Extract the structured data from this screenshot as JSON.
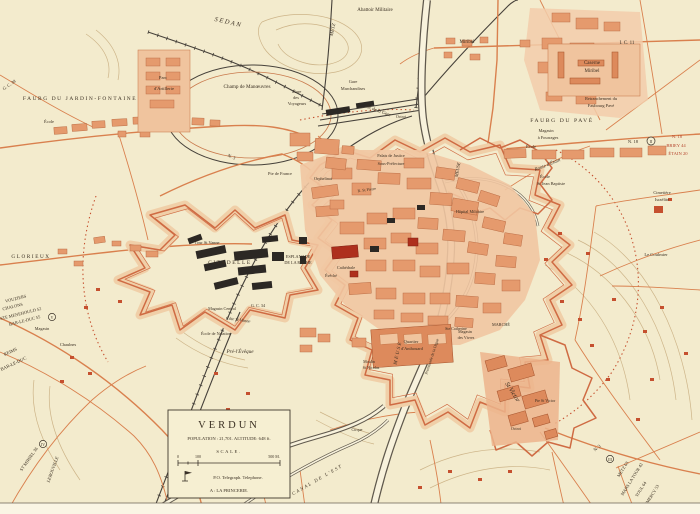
{
  "title": "Plan of Verdun",
  "colors": {
    "background": "#f3ebcd",
    "urban": "#e59a6d",
    "urban_dark": "#dd8a5c",
    "fort_line": "#cf6b43",
    "key_building": "#ae2f1d",
    "military_black": "#2c2824",
    "road": "#d9804e",
    "rail": "#46413a",
    "red_text": "#b5442c"
  },
  "legend": {
    "title": "VERDUN",
    "stats": "POPULATION : 21,701.   ALTITUDE: 648 ft.",
    "scale_label": "SCALE.",
    "tick0": "0",
    "tick100": "100",
    "tick500": "500 M.",
    "symbols": "P.O.   Telegraph.   Telephone.",
    "note": "A : LA PRINCERIE."
  },
  "markers": {
    "east": "II",
    "west": "V",
    "southwest": "IV",
    "southeast": "III"
  },
  "labels": {
    "sedan": "SEDAN",
    "abattoir": "Abattoir Militaire",
    "metz_rail": "METZ",
    "miribel_road": "Miribel",
    "ic11": "I. C. 11",
    "caserne_miribel_1": "Caserne",
    "caserne_miribel_2": "Miribel",
    "retranchement_1": "Retranchement du",
    "retranchement_2": "Faubourg Pavé",
    "faubg_pave": "FAUBG DU PAVÉ",
    "magasin_fourrages_1": "Magasin",
    "magasin_fourrages_2": "à Fourrages",
    "ecole_pave": "École",
    "route_etain": "Route d'Étain",
    "n18_a": "N. 18",
    "n18_b": "N. 18",
    "briey": "BRIEY 44",
    "etain20": "ÉTAIN 20",
    "st_jean_1": "École",
    "st_jean_2": "St Jean Baptiste",
    "cimetiere_1": "Cimetière",
    "cimetiere_2": "Israélite",
    "le_coulmier": "Le Coulmier",
    "gc38": "G. C. 38",
    "faubg_jardin": "FAUBG DU JARDIN-FONTAINE",
    "ecole_jf": "École",
    "parc_1": "Parc",
    "parc_2": "d'Artillerie",
    "champ": "Champ  de  Manœuvres",
    "gare_v1": "Gare",
    "gare_v2": "des",
    "gare_v3": "Voyageurs",
    "gare_m1": "Gare",
    "gare_m2": "Marchandises",
    "av_gare": "Av. de la Gare",
    "octroi_n": "Octroi",
    "n3_w": "N. 3",
    "pte_france": "Pte de France",
    "glorieux": "GLORIEUX",
    "vouziers": "VOUZIERS",
    "chalons": "CHALONS",
    "ste_menehould": "STE MENEHOULD 52",
    "bar_le_duc1": "BAR-LE-DUC 55",
    "reims": "REIMS",
    "bar_le_duc2": "BAR-LE-DUC",
    "magasin_w": "Magasin",
    "chaulnes": "Chaulnes",
    "st_mihiel": "ST MIHIEL 36",
    "lerouville": "LEROUVILLE",
    "tour_st_vanne": "Tour St Vanne",
    "citadelle": "CITADELLE",
    "esplanade_1": "ESPLANADE",
    "esplanade_2": "DE LA ROCHE",
    "magasin_central": "Magasin Central",
    "gc34": "G. C. 34",
    "cote_st_vanne": "Côte St Vanne",
    "ecole_natation": "École de Natation",
    "pre_leveque": "Pré-l'Évêque",
    "anthouard_1": "Quartier",
    "anthouard_2": "d'Anthouard",
    "vivres_1": "Magasin",
    "vivres_2": "des Vivres",
    "moulin_1": "Moulin",
    "moulin_2": "St Nicolas",
    "canal_est": "CANAL DE L'EST",
    "meuse_s": "MEUSE",
    "meuse_n": "MEUSE",
    "promenade": "Promenade de la Digue",
    "cathedrale": "Cathédrale",
    "eveche": "Évêché",
    "palais": "Palais de Justice",
    "sous_pref": "Sous-Préfecture",
    "r_st_pierre": "R. St Pierre",
    "orphelinat": "Orphelinat",
    "hopital": "Hôpital Militaire",
    "marche": "MARCHÉ",
    "ste_catherine": "Ste Catherine",
    "st_victor": "St Victor",
    "pte_st_victor": "Pte St Victor",
    "octroi_s": "Octroi",
    "cirque": "Cirque",
    "n3_se": "N. 3",
    "metz63": "METZ 63",
    "mars_la_tour": "MARS LA TOUR 42",
    "toul": "TOUL 64",
    "commercy": "COMMERCY 53"
  }
}
